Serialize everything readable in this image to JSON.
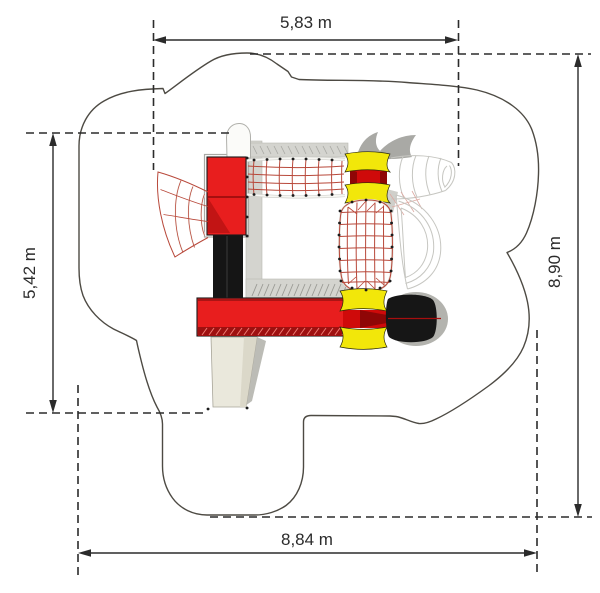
{
  "drawing": {
    "kind": "playground-equipment-top-view-plan",
    "dimensions": {
      "top": "5,83 m",
      "bottom": "8,84 m",
      "left": "5,42 m",
      "right": "8,90 m"
    }
  },
  "colors": {
    "background": "#ffffff",
    "outline": "#4d4a43",
    "dimension-line": "#2b2b2b",
    "equipment-red": "#e81e1e",
    "equipment-dark-red": "#9e1010",
    "accent-red": "#cf0a0a",
    "funnel-dark-red": "#8f0606",
    "equipment-yellow": "#f2e70a",
    "equipment-black": "#161616",
    "ramp-beige": "#eae8dc",
    "net-red": "#b8483a",
    "frame-gray": "#c6c6c1",
    "deck-gray": "#d4d4cf",
    "shadow-gray": "#b3b3ae"
  }
}
